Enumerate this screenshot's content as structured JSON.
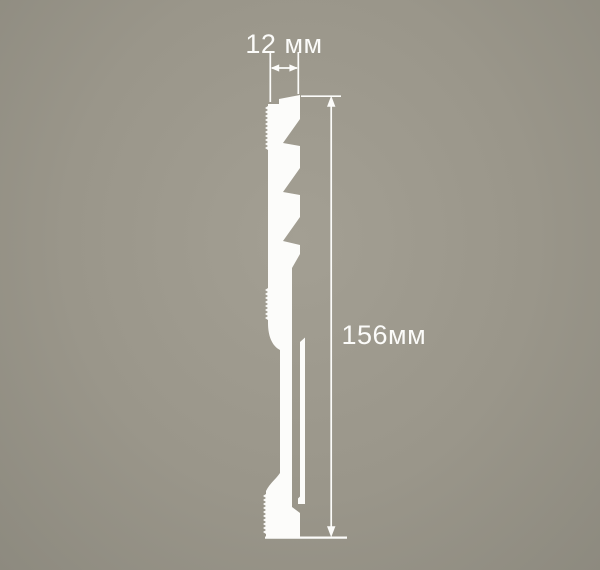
{
  "colors": {
    "background": "#9A968A",
    "profile": "#FCFCFA",
    "dimension_lines": "#FCFCFA",
    "label_text": "#FBFBF9"
  },
  "diagram": {
    "kind": "skirting-board profile cross-section drawing",
    "dimensions": {
      "width": {
        "label": "12 мм",
        "value": 12,
        "unit": "мм"
      },
      "height": {
        "label": "156мм",
        "value": 156,
        "unit": "мм"
      }
    }
  }
}
